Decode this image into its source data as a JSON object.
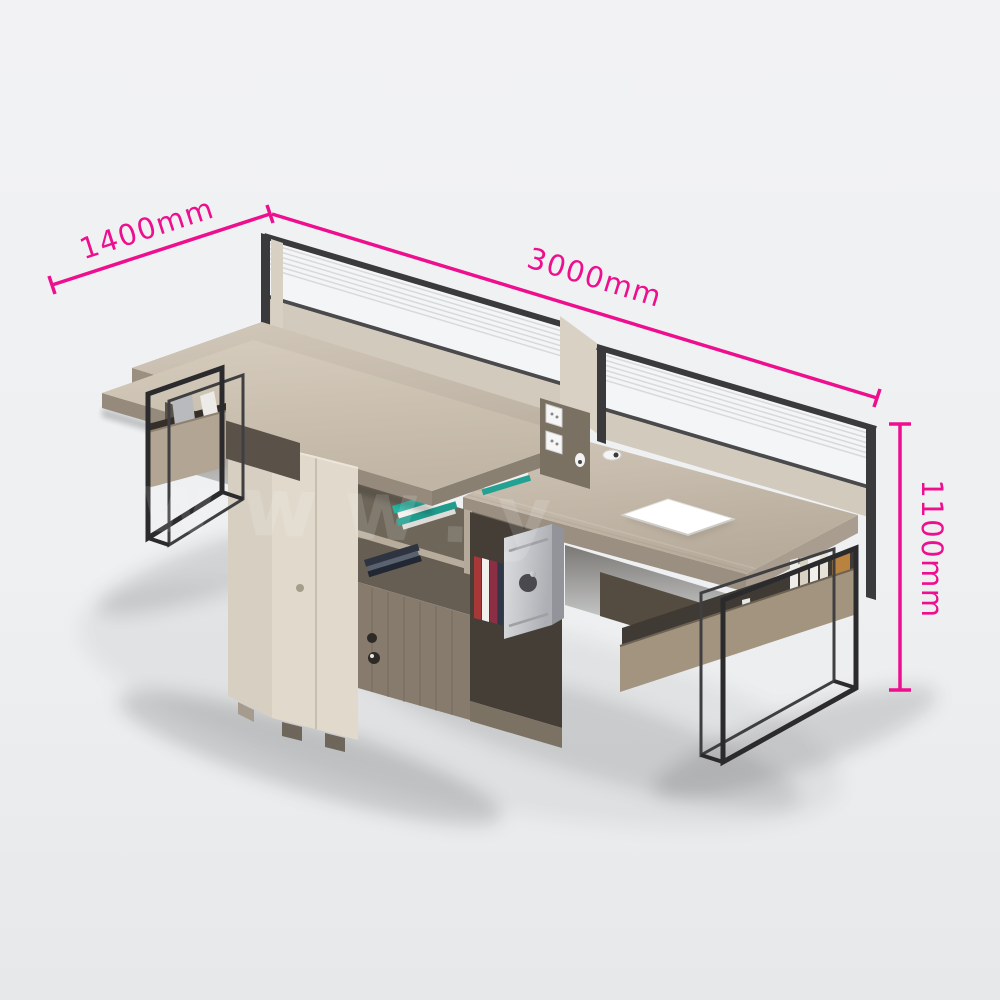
{
  "image": {
    "type": "product-photo",
    "subject": "Two-person staggered office workstation with privacy screens, central storage cabinet, bookshelf cubbies and black metal frame legs"
  },
  "dimensions": {
    "width_label": "1400mm",
    "length_label": "3000mm",
    "height_label": "1100mm"
  },
  "watermark": {
    "text": "www.y"
  },
  "colors": {
    "dimension_accent": "#ee0f8e",
    "background": "#eff0f2",
    "desk_wood": "#c9beaf",
    "desk_wood_edge": "#9a8f81",
    "plank_wood": "#cdc2b2",
    "cabinet_cream": "#e0d9cc",
    "cabinet_cream_side": "#d6cfc2",
    "dark_wood_doors": "#867b6d",
    "shelf_interior": "#6e6659",
    "screen_glass": "#f4f5f7",
    "screen_frame": "#3a3a3c",
    "screen_panel": "#d2cabd",
    "metal_frame": "#2b2b2d",
    "book_teal": "#2ab3a3",
    "basket_tan": "#b3a593",
    "rack_wood": "#a2947f",
    "computer_silver": "#c9cacd",
    "paper_white": "#fdfdfc"
  }
}
